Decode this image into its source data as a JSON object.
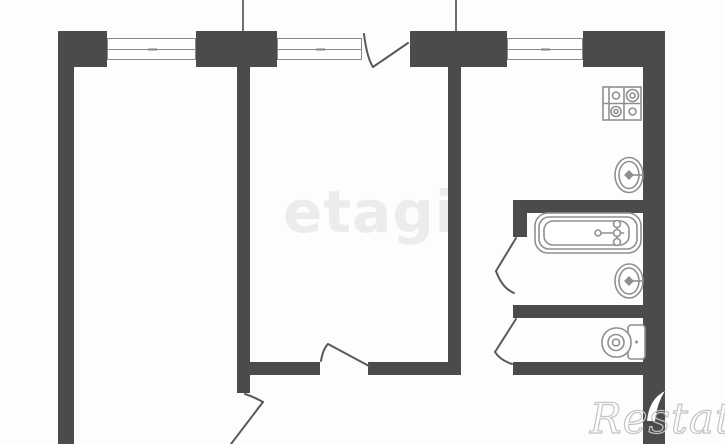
{
  "canvas": {
    "width": 725,
    "height": 444
  },
  "colors": {
    "background": "#fdfdfd",
    "wall": "#4b4b4e",
    "window_border": "#8a8a8c",
    "door_line": "#5a5a5c",
    "fixture_line": "#8f8f91",
    "wm_center": "#ececec",
    "wm_corner": "#c4c4c4"
  },
  "watermarks": {
    "center": {
      "text": "etagi"
    },
    "corner": {
      "text": "Restate"
    }
  },
  "fixtures": {
    "stove": "4-burner stove",
    "kitchen_sink": "kitchen sink",
    "bathtub": "bathtub",
    "bathroom_sink": "wash basin",
    "toilet": "toilet with cistern"
  },
  "openings": {
    "window_1": "window",
    "window_2": "window",
    "kitchen_window": "kitchen window",
    "balcony_door": "balcony door",
    "room_door": "room door",
    "hall_door": "hall door",
    "bathroom_door": "bathroom door",
    "wc_door": "wc door"
  }
}
